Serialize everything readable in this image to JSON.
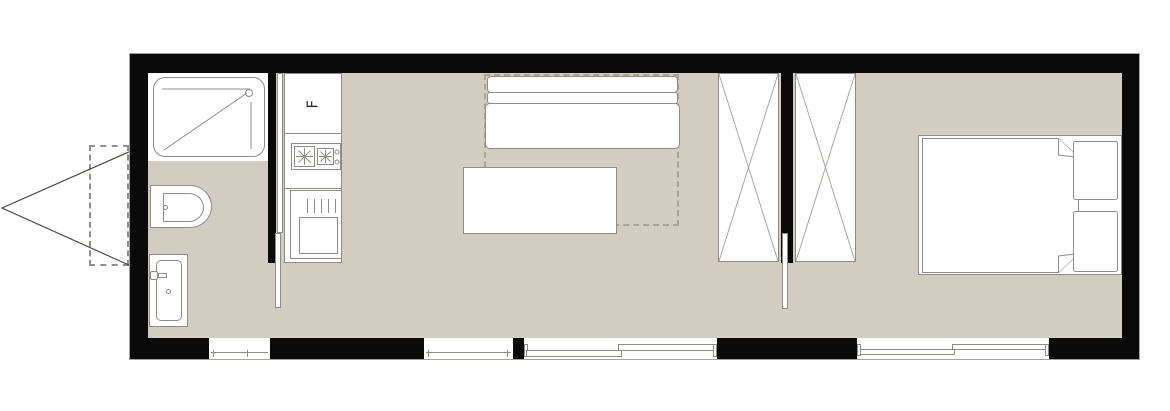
{
  "title": "Tiny house trailer floor plan",
  "labels": {
    "fridge": "F"
  },
  "colors": {
    "wall": "#0a0a0a",
    "floor": "#d2ccc1",
    "line": "#8c8c89",
    "fill": "#ffffff",
    "dash": "#8f8f8b",
    "sofadash": "#aba293",
    "xline": "#a8a8a2",
    "hitch": "#4c4a45"
  },
  "exterior": {
    "objects": [
      "trailer-hitch-triangle",
      "hitch-coupler-dashed-box"
    ]
  },
  "rooms": [
    {
      "name": "bathroom",
      "fixtures": [
        "shower-tray",
        "toilet",
        "wash-basin",
        "frosted-window",
        "pocket-sliding-door"
      ]
    },
    {
      "name": "kitchen",
      "fixtures": [
        "refrigerator",
        "two-burner-cooktop",
        "sink-cabinet"
      ]
    },
    {
      "name": "living-room",
      "fixtures": [
        "sofa",
        "sofa-bed-foldout-dashed-outline",
        "coffee-table",
        "window",
        "sliding-glass-door"
      ]
    },
    {
      "name": "wardrobe-hall",
      "fixtures": [
        "wardrobe-left",
        "wardrobe-right",
        "pocket-sliding-door"
      ]
    },
    {
      "name": "bedroom",
      "fixtures": [
        "double-bed",
        "pillow-top",
        "pillow-bottom",
        "sliding-window"
      ]
    }
  ]
}
